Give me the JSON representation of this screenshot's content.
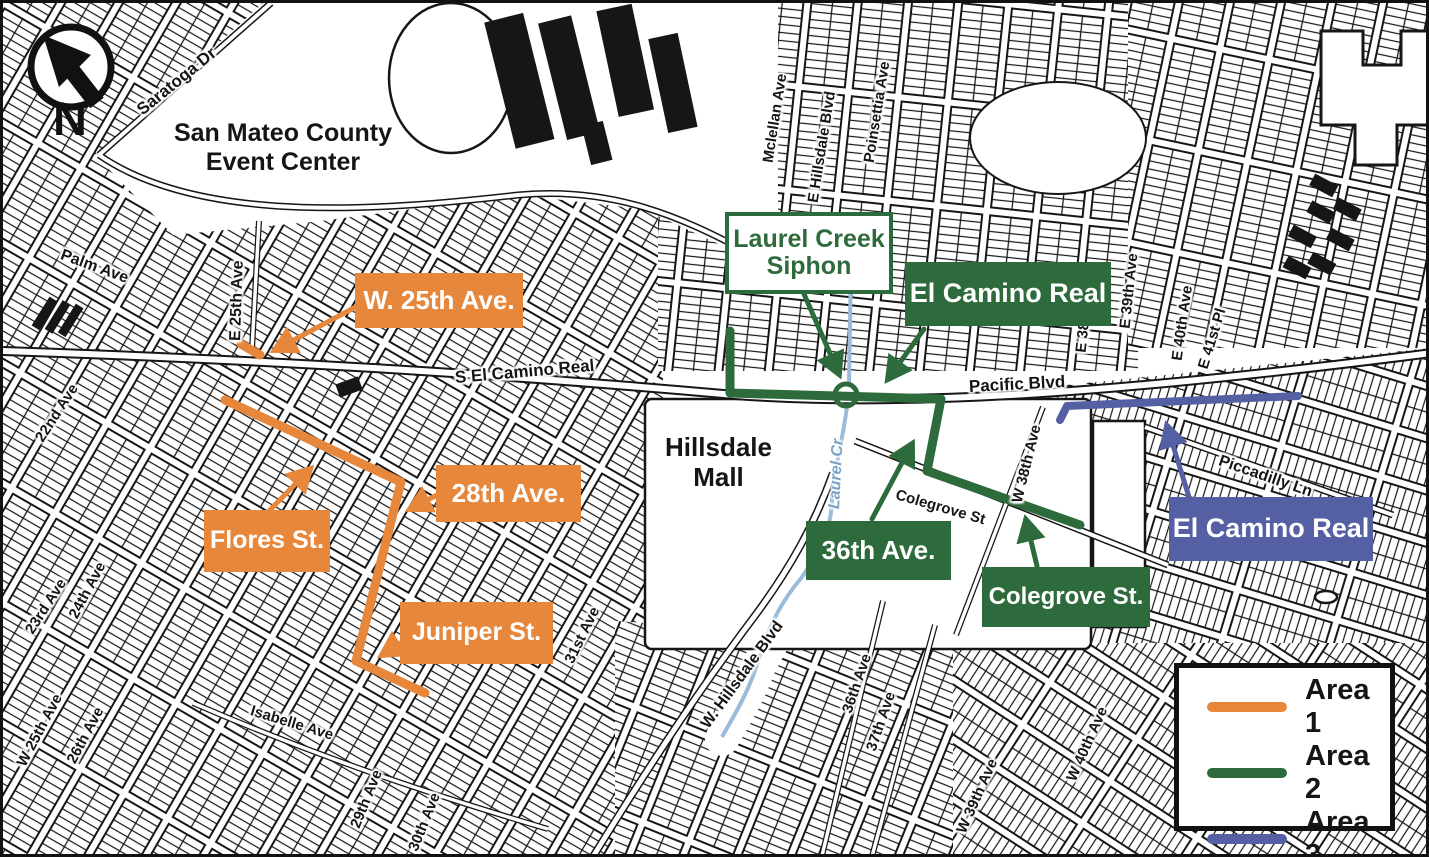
{
  "map_title": "San Mateo construction areas map",
  "north": "N",
  "colors": {
    "area1": "#E6873C",
    "area2": "#2E6B3C",
    "area3": "#5560A4",
    "creek": "#9ABCDA",
    "creek_label": "#7BA3C8",
    "ink": "#151515"
  },
  "places": {
    "event_center_line1": "San Mateo County",
    "event_center_line2": "Event Center",
    "mall_line1": "Hillsdale",
    "mall_line2": "Mall"
  },
  "streets": {
    "saratoga": "Saratoga Dr",
    "palm": "Palm Ave",
    "e25th": "E 25th Ave",
    "ave22": "22nd Ave",
    "ave23": "23rd Ave",
    "ave24": "24th Ave",
    "w25th": "W 25th Ave",
    "ave26": "26th Ave",
    "isabelle": "Isabelle Ave",
    "ave29": "29th Ave",
    "ave30": "30th Ave",
    "ave31": "31st Ave",
    "whillsdale": "W. Hillsdale Blvd",
    "ave36": "36th Ave",
    "ave37": "37th Ave",
    "w39th": "W 39th Ave",
    "w40th": "W 40th Ave",
    "selcamino": "S El Camino Real",
    "pacific": "Pacific Blvd",
    "mclellan": "Mclellan Ave",
    "ehillsdale": "E Hillsdale Blvd",
    "poinsettia": "Poinsettia Ave",
    "e38th": "E 38th Ave",
    "e39th": "E 39th Ave",
    "e40th": "E 40th Ave",
    "e41st": "E 41st Pl",
    "w38th": "W 38th Ave",
    "colegrove": "Colegrove St",
    "piccadilly": "Piccadilly Ln",
    "laurelcr": "Laurel Cr"
  },
  "annotations": {
    "area1": {
      "w25th": "W. 25th Ave.",
      "ave28": "28th Ave.",
      "flores": "Flores St.",
      "juniper": "Juniper St."
    },
    "area2": {
      "laurel_line1": "Laurel Creek",
      "laurel_line2": "Siphon",
      "el_camino": "El Camino Real",
      "ave36": "36th Ave.",
      "colegrove": "Colegrove St."
    },
    "area3": {
      "el_camino": "El Camino Real"
    }
  },
  "legend": {
    "items": [
      {
        "label": "Area 1",
        "color_key": "area1"
      },
      {
        "label": "Area 2",
        "color_key": "area2"
      },
      {
        "label": "Area 3",
        "color_key": "area3"
      }
    ]
  }
}
